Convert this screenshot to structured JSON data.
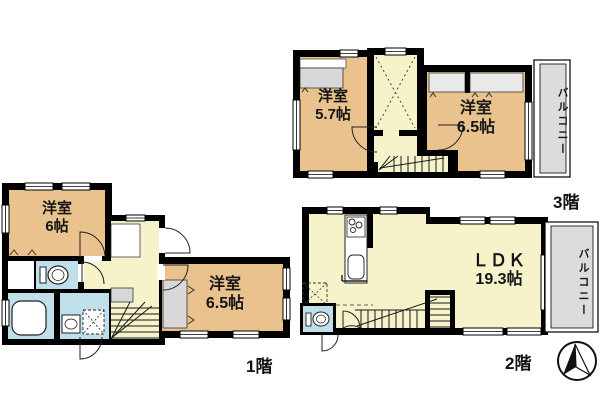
{
  "palette": {
    "wall": "#000000",
    "room_tan": "#e9c28e",
    "hall_yellow": "#f6f3cb",
    "wet_blue": "#bfe0eb",
    "closet_gray": "#d8d8d8",
    "closet_light": "#e9e9e9",
    "balcony_gray": "#dcdcdc",
    "line": "#1a1a1a"
  },
  "floors": {
    "f3": {
      "label": "3階",
      "rooms": {
        "bedroom_a": {
          "name": "洋室",
          "size": "5.7帖"
        },
        "bedroom_b": {
          "name": "洋室",
          "size": "6.5帖"
        },
        "balcony": {
          "name": "バルコニー"
        }
      }
    },
    "f2": {
      "label": "2階",
      "rooms": {
        "ldk": {
          "name": "ＬＤＫ",
          "size": "19.3帖"
        },
        "balcony": {
          "name": "バルコニー"
        }
      }
    },
    "f1": {
      "label": "1階",
      "rooms": {
        "bedroom_a": {
          "name": "洋室",
          "size": "6帖"
        },
        "bedroom_b": {
          "name": "洋室",
          "size": "6.5帖"
        }
      }
    }
  },
  "icons": {
    "compass": "north-arrow-icon",
    "toilet": "toilet-icon",
    "bathtub": "bathtub-icon",
    "sink": "sink-icon",
    "stove": "stove-icon",
    "washer": "washing-machine-icon",
    "void_x": "open-void-cross-icon"
  }
}
